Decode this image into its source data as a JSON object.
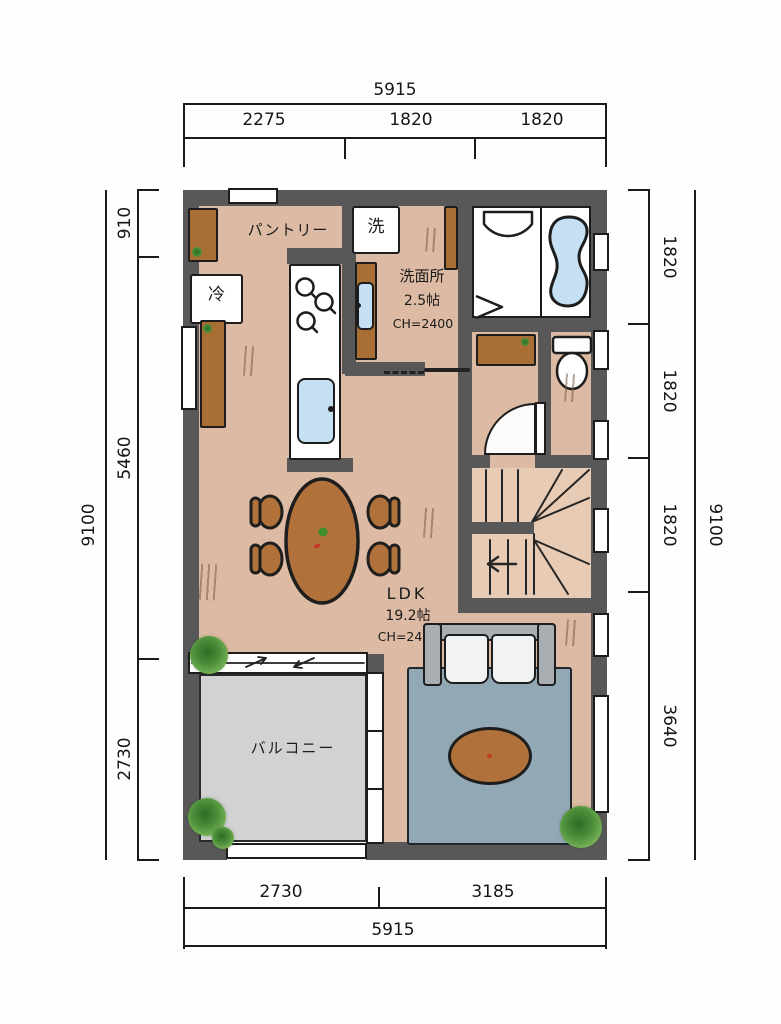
{
  "dimensions": {
    "top": {
      "overall": "5915",
      "segments": [
        "2275",
        "1820",
        "1820"
      ]
    },
    "bottom": {
      "overall": "5915",
      "segments": [
        "2730",
        "3185"
      ]
    },
    "left": {
      "overall": "9100",
      "segments": [
        "910",
        "5460",
        "2730"
      ]
    },
    "right": {
      "overall": "9100",
      "segments": [
        "1820",
        "1820",
        "1820",
        "3640"
      ]
    }
  },
  "rooms": {
    "pantry_label": "パントリー",
    "laundry_label": "洗",
    "fridge_label": "冷",
    "washroom": {
      "name": "洗面所",
      "size": "2.5帖",
      "ceiling_height": "CH=2400"
    },
    "ldk": {
      "name": "LDK",
      "size": "19.2帖",
      "ceiling_height": "CH=2400"
    },
    "balcony_label": "バルコニー"
  },
  "colors": {
    "wall": "#585858",
    "floor": "#dcbaa3",
    "stairs_floor": "#e8cbb4",
    "balcony_floor": "#d2d2d2",
    "water": "#c5e0f2",
    "wood": "#a96e33",
    "table": "#b0713a",
    "rug": "#93a8b5",
    "sofa": "#a9aeb3",
    "outline": "#1d1d1d",
    "plant": "#4c8f3a"
  }
}
